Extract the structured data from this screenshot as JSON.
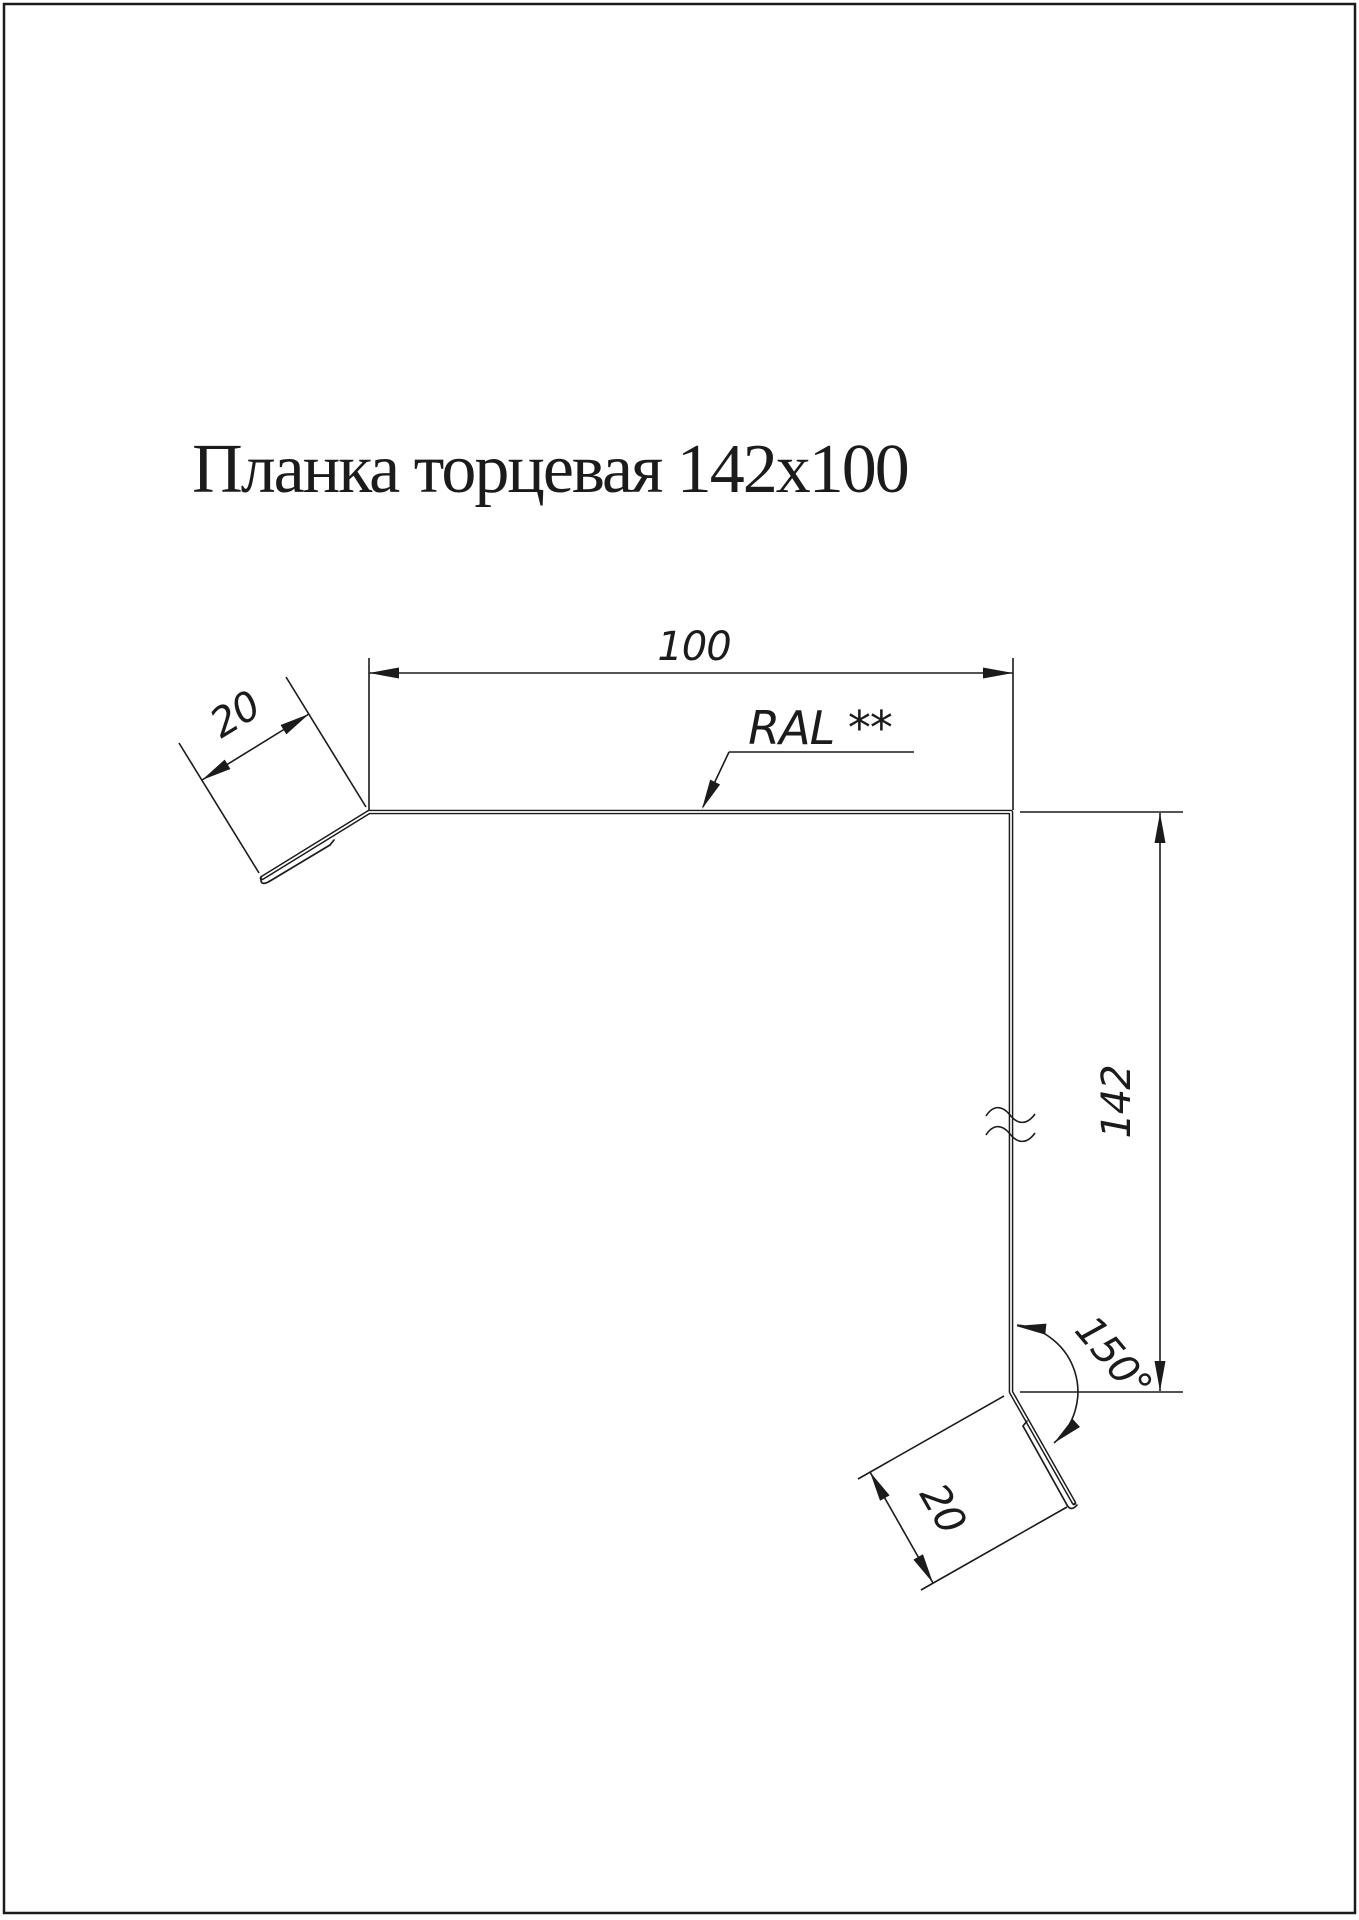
{
  "page": {
    "title": "Планка торцевая 142x100"
  },
  "drawing": {
    "dim_width_top": "100",
    "dim_flange_top": "20",
    "dim_height_right": "142",
    "dim_flange_bottom": "20",
    "angle_bottom": "150°",
    "color_note": "RAL **"
  },
  "colors": {
    "line": "#1b1b1b",
    "background": "#ffffff"
  }
}
